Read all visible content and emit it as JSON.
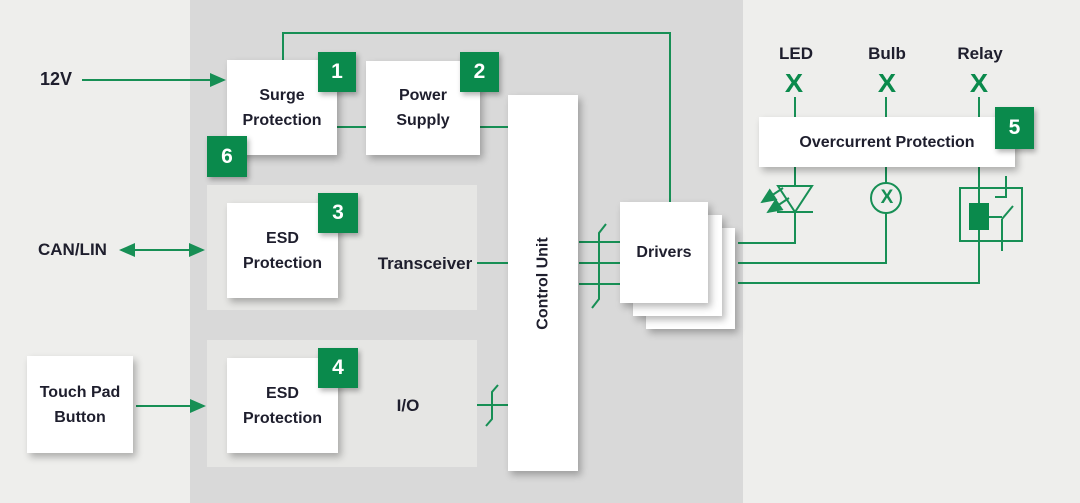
{
  "colors": {
    "green_line": "#178f55",
    "green_fill": "#0a8a4c",
    "outer_panel": "#d9d9d9",
    "inner_panel": "#e6e6e4",
    "page_bg": "#eeeeec",
    "text_dark": "#1e1e2d",
    "box_bg": "#ffffff"
  },
  "sources": {
    "supply_label": "12V",
    "bus_label": "CAN/LIN",
    "touch_line1": "Touch Pad",
    "touch_line2": "Button"
  },
  "blocks": {
    "surge_line1": "Surge",
    "surge_line2": "Protection",
    "power_line1": "Power",
    "power_line2": "Supply",
    "esd_can_line1": "ESD",
    "esd_can_line2": "Protection",
    "esd_io_line1": "ESD",
    "esd_io_line2": "Protection",
    "transceiver": "Transceiver",
    "io": "I/O",
    "control_unit": "Control Unit",
    "drivers": "Drivers",
    "overcurrent": "Overcurrent Protection"
  },
  "badges": {
    "surge": "1",
    "power": "2",
    "esd_can": "3",
    "esd_io": "4",
    "overcurrent": "5",
    "surge_alt": "6"
  },
  "loads": {
    "led_label": "LED",
    "bulb_label": "Bulb",
    "relay_label": "Relay",
    "cross_mark": "X"
  }
}
